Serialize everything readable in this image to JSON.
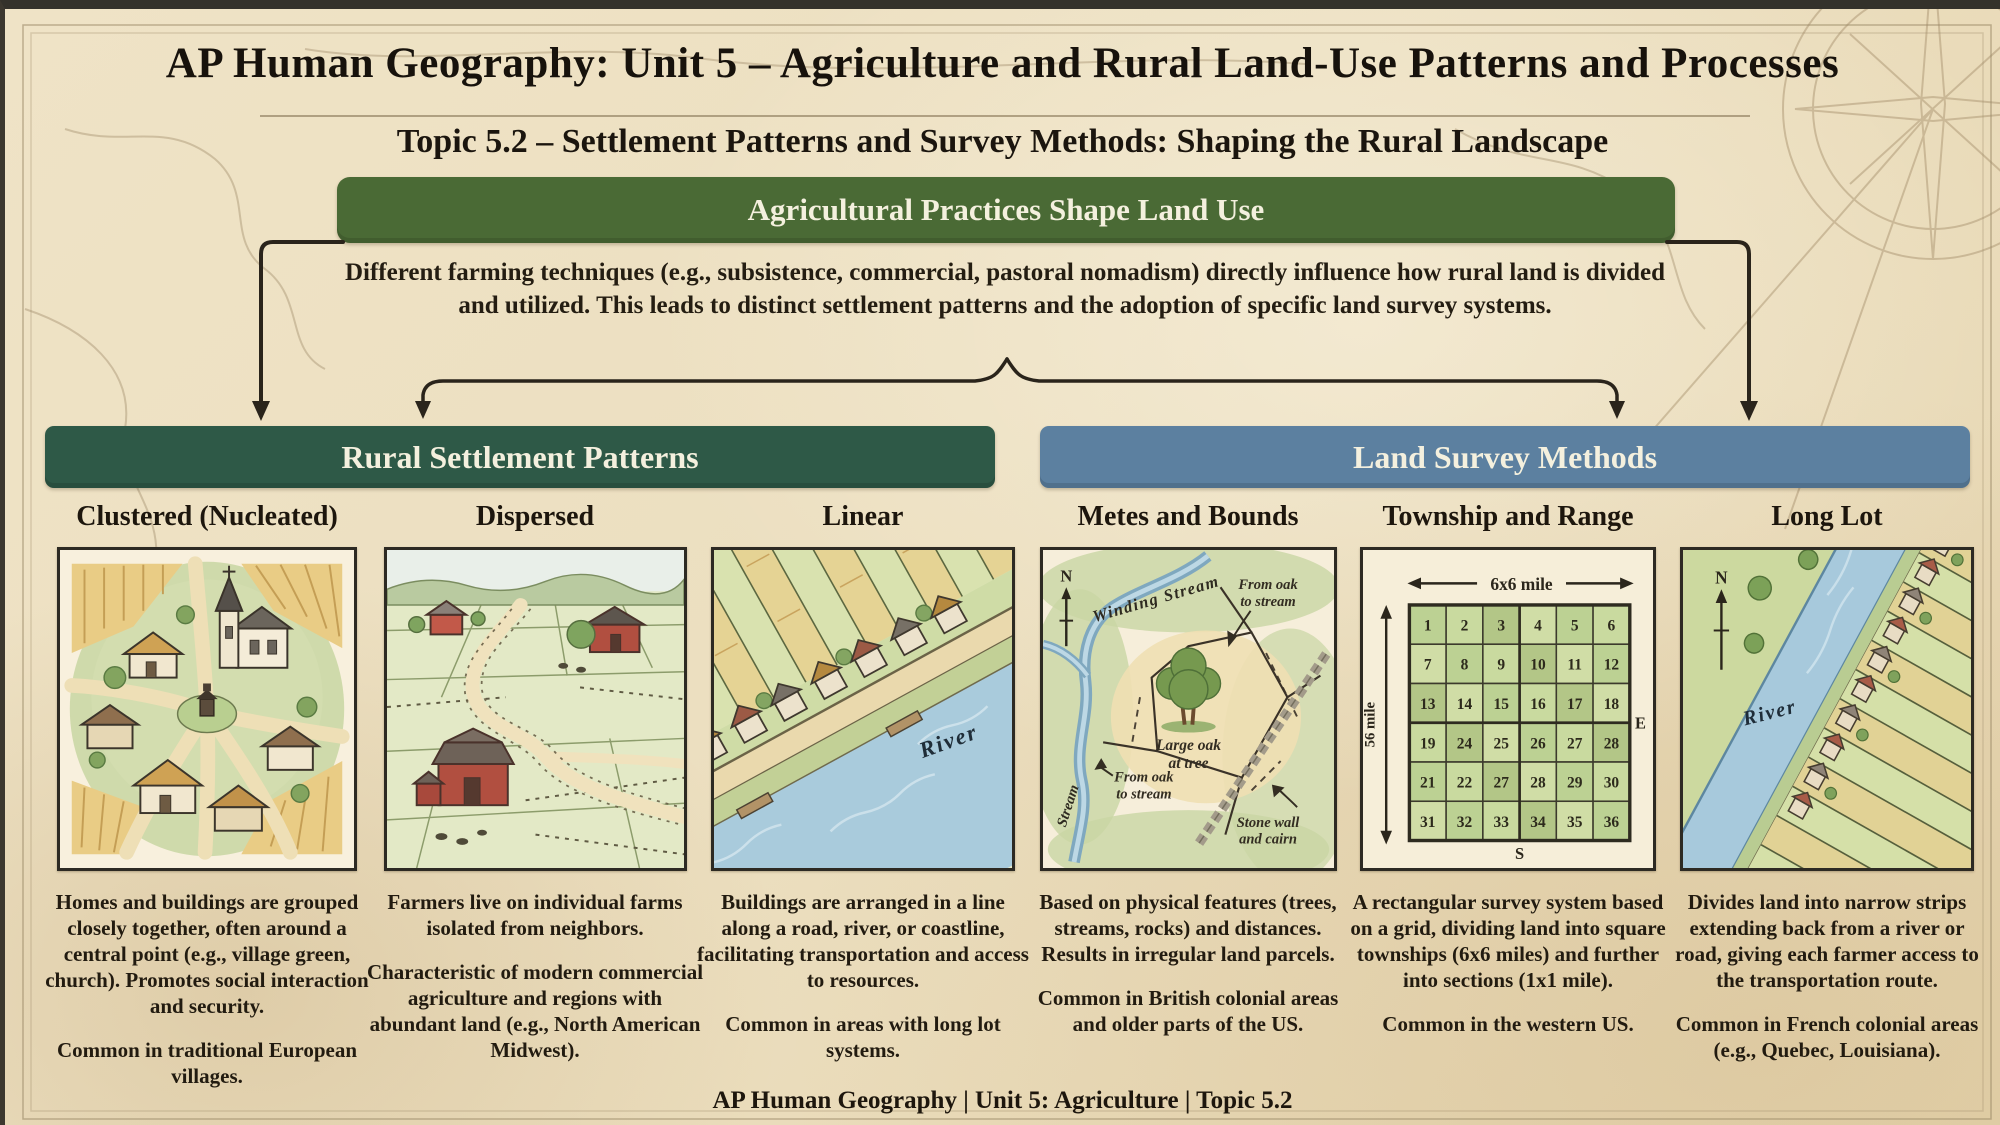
{
  "page": {
    "title": "AP Human Geography: Unit 5 – Agriculture and Rural Land-Use Patterns and Processes",
    "subtitle": "Topic 5.2 – Settlement Patterns and Survey Methods: Shaping the Rural Landscape",
    "footer": "AP Human Geography | Unit 5: Agriculture | Topic 5.2"
  },
  "flow": {
    "banner": "Agricultural Practices Shape Land Use",
    "description": "Different farming techniques (e.g., subsistence, commercial, pastoral nomadism) directly influence how rural land is divided and utilized. This leads to distinct settlement patterns and the adoption of specific land survey systems."
  },
  "sections": [
    {
      "title": "Rural Settlement Patterns",
      "color": "#2e5947"
    },
    {
      "title": "Land Survey Methods",
      "color": "#5c80a0"
    }
  ],
  "columns": [
    {
      "heading": "Clustered (Nucleated)",
      "paragraphs": [
        "Homes and buildings are grouped closely together, often around a central point (e.g., village green, church). Promotes social interaction and security.",
        "Common in traditional European villages."
      ]
    },
    {
      "heading": "Dispersed",
      "paragraphs": [
        "Farmers live on individual farms isolated from neighbors.",
        "Characteristic of modern commercial agriculture and regions with abundant land (e.g., North American Midwest)."
      ]
    },
    {
      "heading": "Linear",
      "paragraphs": [
        "Buildings are arranged in a line along a road, river, or coastline, facilitating transportation and access to resources.",
        "Common in areas with long lot systems."
      ]
    },
    {
      "heading": "Metes and Bounds",
      "paragraphs": [
        "Based on physical features (trees, streams, rocks) and distances. Results in irregular land parcels.",
        "Common in British colonial areas and older parts of the US."
      ]
    },
    {
      "heading": "Township and Range",
      "paragraphs": [
        "A rectangular survey system based on a grid, dividing land into square townships (6x6 miles) and further into sections (1x1 mile).",
        "Common in the western US."
      ]
    },
    {
      "heading": "Long Lot",
      "paragraphs": [
        "Divides land into narrow strips extending back from a river or road, giving each farmer access to the transportation route.",
        "Common in French colonial areas (e.g., Quebec, Louisiana)."
      ]
    }
  ],
  "illustrations": {
    "linear": {
      "river_label": "River"
    },
    "metes": {
      "compass": "N",
      "winding_stream": "Winding Stream",
      "stream": "Stream",
      "note_top_line1": "From oak",
      "note_top_line2": "to stream",
      "note_left_line1": "From oak",
      "note_left_line2": "to stream",
      "oak_line1": "Large oak",
      "oak_line2": "at tree",
      "wall_line1": "Stone wall",
      "wall_line2": "and cairn"
    },
    "township": {
      "top_scale": "6x6 mile",
      "side_scale": "56 mile",
      "east": "E",
      "south": "S",
      "grid": [
        [
          1,
          2,
          3,
          4,
          5,
          6
        ],
        [
          7,
          8,
          9,
          10,
          11,
          12
        ],
        [
          13,
          14,
          15,
          16,
          17,
          18
        ],
        [
          19,
          24,
          25,
          26,
          27,
          28
        ],
        [
          21,
          22,
          27,
          28,
          29,
          30
        ],
        [
          31,
          32,
          33,
          34,
          35,
          36
        ]
      ]
    },
    "longlot": {
      "compass": "N",
      "river_label": "River"
    }
  },
  "palette": {
    "top_banner_green": "#4a6a35",
    "settlement_green": "#2e5947",
    "survey_blue": "#5c80a0",
    "paper": "#ecdfc0",
    "ink": "#211b12"
  }
}
